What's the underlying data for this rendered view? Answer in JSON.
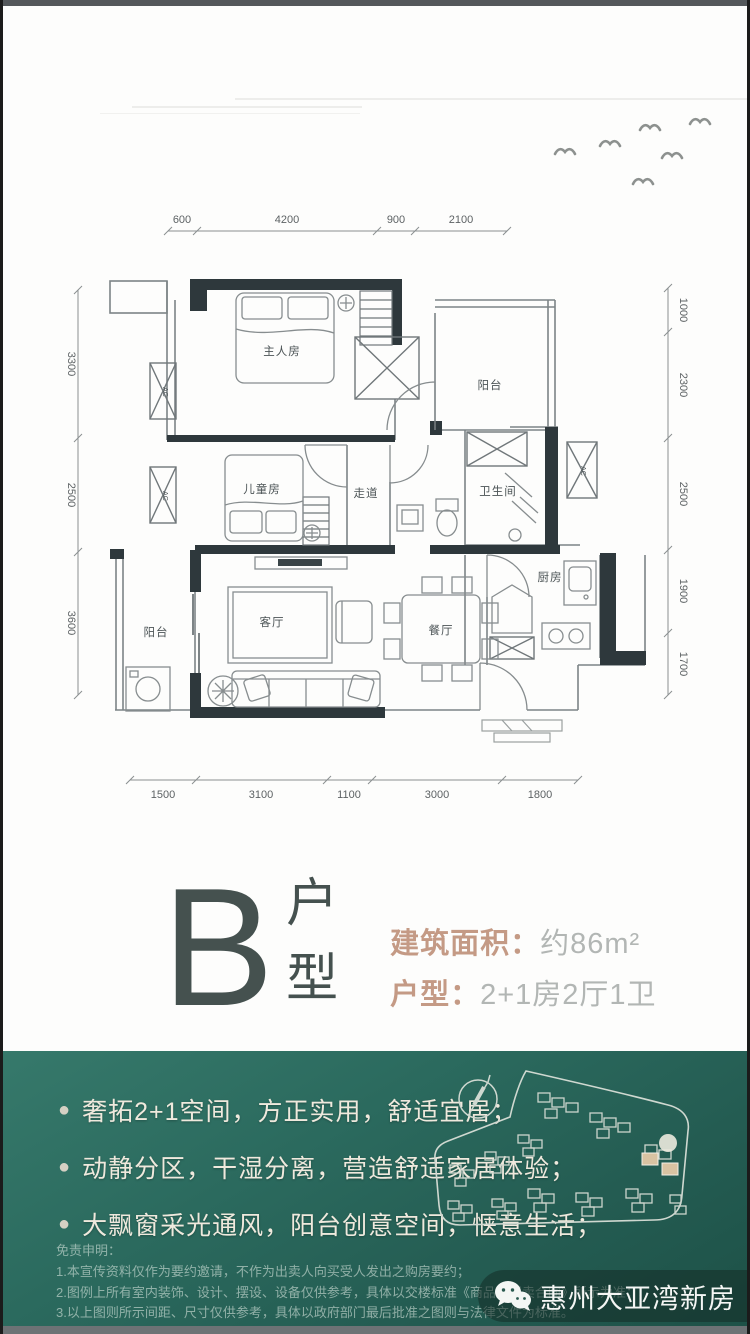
{
  "meta": {
    "accent_color": "#c49a85",
    "teal_color": "#2b6a5e",
    "highlight_building_color": "#d9c3a2"
  },
  "floorplan": {
    "rooms": {
      "master": "主人房",
      "balcony_top": "阳台",
      "kids": "儿童房",
      "corridor": "走道",
      "bath": "卫生间",
      "kitchen": "厨房",
      "dining": "餐厅",
      "living": "客厅",
      "balcony_left": "阳台",
      "ac": "AC"
    },
    "dims": {
      "top": [
        "600",
        "4200",
        "900",
        "2100"
      ],
      "bottom": [
        "1500",
        "3100",
        "1100",
        "3000",
        "1800"
      ],
      "left": [
        "3300",
        "2500",
        "3600"
      ],
      "right": [
        "1000",
        "2300",
        "2500",
        "1900",
        "1700"
      ]
    }
  },
  "title": {
    "letter": "B",
    "suffix": "户型",
    "area_label": "建筑面积：",
    "area_value": "约86m²",
    "layout_label": "户型：",
    "layout_value": "2+1房2厅1卫"
  },
  "features": {
    "bullet": "●",
    "items": [
      "奢拓2+1空间，方正实用，舒适宜居；",
      "动静分区，干湿分离，营造舒适家居体验；",
      "大飘窗采光通风，阳台创意空间，惬意生活；"
    ]
  },
  "disclaimer": {
    "heading": "免责申明：",
    "lines": [
      "1.本宣传资料仅作为要约邀请，不作为出卖人向买受人发出之购房要约；",
      "2.图例上所有室内装饰、设计、摆设、设备仅供参考，具体以交楼标准《商品房买卖合同》所示为准；",
      "3.以上图则所示间距、尺寸仅供参考，具体以政府部门最后批准之图则与法律文件为标准。"
    ]
  },
  "badge": {
    "label": "惠州大亚湾新房"
  }
}
